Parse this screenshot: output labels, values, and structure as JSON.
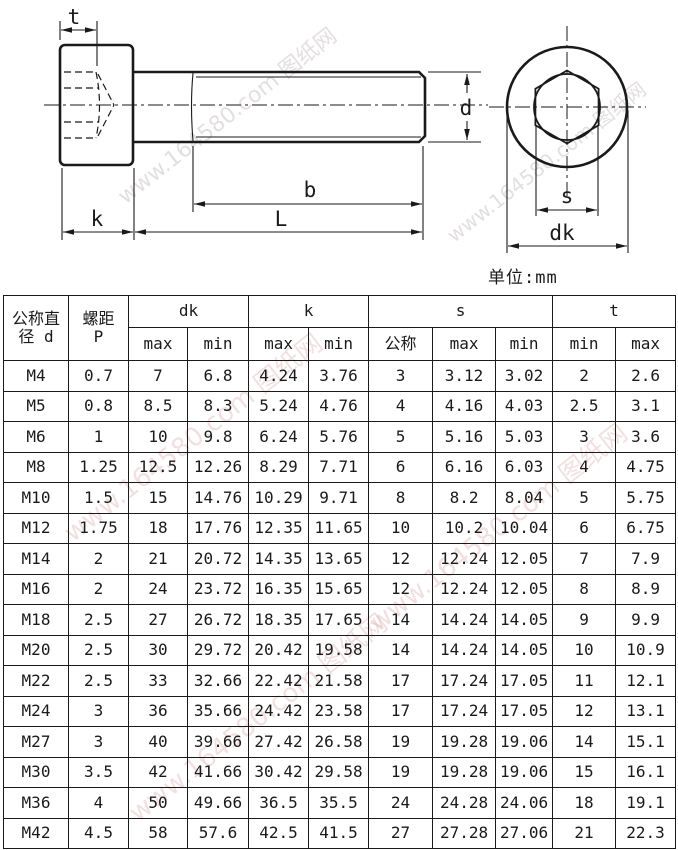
{
  "unit_label": "单位:mm",
  "watermark": {
    "text": "www.164580.com 图纸网"
  },
  "drawing": {
    "labels": {
      "t": "t",
      "k": "k",
      "L": "L",
      "b": "b",
      "d": "d",
      "s": "s",
      "dk": "dk"
    }
  },
  "table": {
    "header": {
      "diameter_line1": "公称直",
      "diameter_line2": "径 d",
      "pitch_line1": "螺距",
      "pitch_line2": "P",
      "group_dk": "dk",
      "group_k": "k",
      "group_s": "s",
      "group_t": "t",
      "sub": {
        "dk_max": "max",
        "dk_min": "min",
        "k_max": "max",
        "k_min": "min",
        "s_nom": "公称",
        "s_max": "max",
        "s_min": "min",
        "t_min": "min",
        "t_max": "max"
      }
    },
    "rows": [
      [
        "M4",
        "0.7",
        "7",
        "6.8",
        "4.24",
        "3.76",
        "3",
        "3.12",
        "3.02",
        "2",
        "2.6"
      ],
      [
        "M5",
        "0.8",
        "8.5",
        "8.3",
        "5.24",
        "4.76",
        "4",
        "4.16",
        "4.03",
        "2.5",
        "3.1"
      ],
      [
        "M6",
        "1",
        "10",
        "9.8",
        "6.24",
        "5.76",
        "5",
        "5.16",
        "5.03",
        "3",
        "3.6"
      ],
      [
        "M8",
        "1.25",
        "12.5",
        "12.26",
        "8.29",
        "7.71",
        "6",
        "6.16",
        "6.03",
        "4",
        "4.75"
      ],
      [
        "M10",
        "1.5",
        "15",
        "14.76",
        "10.29",
        "9.71",
        "8",
        "8.2",
        "8.04",
        "5",
        "5.75"
      ],
      [
        "M12",
        "1.75",
        "18",
        "17.76",
        "12.35",
        "11.65",
        "10",
        "10.2",
        "10.04",
        "6",
        "6.75"
      ],
      [
        "M14",
        "2",
        "21",
        "20.72",
        "14.35",
        "13.65",
        "12",
        "12.24",
        "12.05",
        "7",
        "7.9"
      ],
      [
        "M16",
        "2",
        "24",
        "23.72",
        "16.35",
        "15.65",
        "12",
        "12.24",
        "12.05",
        "8",
        "8.9"
      ],
      [
        "M18",
        "2.5",
        "27",
        "26.72",
        "18.35",
        "17.65",
        "14",
        "14.24",
        "14.05",
        "9",
        "9.9"
      ],
      [
        "M20",
        "2.5",
        "30",
        "29.72",
        "20.42",
        "19.58",
        "14",
        "14.24",
        "14.05",
        "10",
        "10.9"
      ],
      [
        "M22",
        "2.5",
        "33",
        "32.66",
        "22.42",
        "21.58",
        "17",
        "17.24",
        "17.05",
        "11",
        "12.1"
      ],
      [
        "M24",
        "3",
        "36",
        "35.66",
        "24.42",
        "23.58",
        "17",
        "17.24",
        "17.05",
        "12",
        "13.1"
      ],
      [
        "M27",
        "3",
        "40",
        "39.66",
        "27.42",
        "26.58",
        "19",
        "19.28",
        "19.06",
        "14",
        "15.1"
      ],
      [
        "M30",
        "3.5",
        "42",
        "41.66",
        "30.42",
        "29.58",
        "19",
        "19.28",
        "19.06",
        "15",
        "16.1"
      ],
      [
        "M36",
        "4",
        "50",
        "49.66",
        "36.5",
        "35.5",
        "24",
        "24.28",
        "24.06",
        "18",
        "19.1"
      ],
      [
        "M42",
        "4.5",
        "58",
        "57.6",
        "42.5",
        "41.5",
        "27",
        "27.28",
        "27.06",
        "21",
        "22.3"
      ]
    ]
  }
}
